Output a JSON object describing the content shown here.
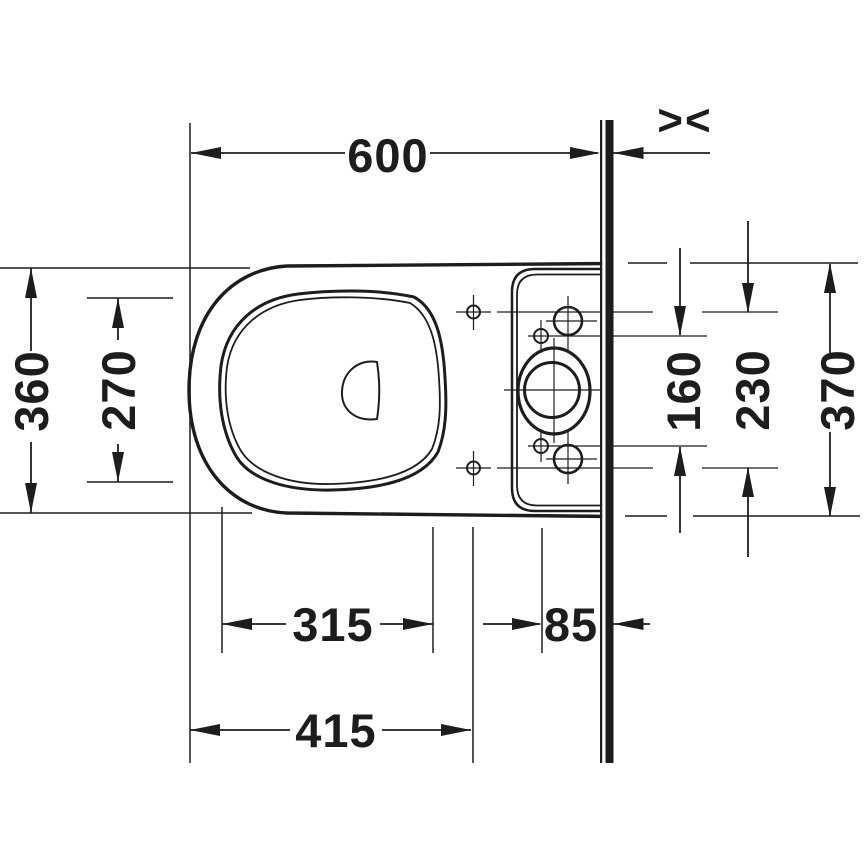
{
  "drawing": {
    "title": "WC plan view technical drawing",
    "wall_symbol": "><",
    "colors": {
      "ink": "#1d1d1b",
      "bg": "#ffffff"
    },
    "dims": {
      "front_to_wall": "600",
      "body_width": "360",
      "bowl_inner_width": "270",
      "fixing_holes_spacing": "160",
      "hinge_holes_spacing": "230",
      "tank_width": "370",
      "bowl_inner_length": "315",
      "holes_to_wall": "85",
      "front_to_hinge_holes": "415"
    }
  }
}
